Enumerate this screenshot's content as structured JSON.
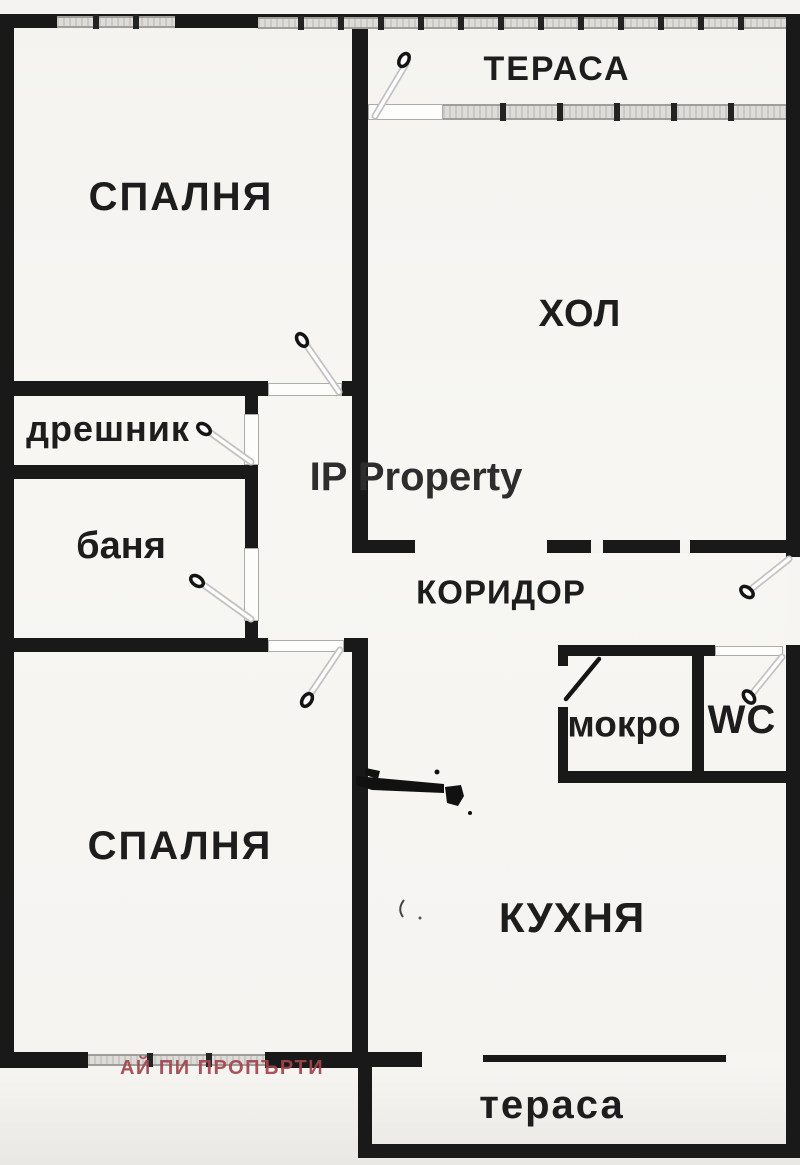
{
  "watermarks": {
    "center": "IP Property",
    "agency": "АЙ ПИ ПРОПЪРТИ"
  },
  "rooms": {
    "terrace_top": "ТЕРАСА",
    "bedroom_top": "СПАЛНЯ",
    "living_room": "ХОЛ",
    "closet": "дрешник",
    "bathroom": "баня",
    "corridor": "КОРИДОР",
    "utility": "мокро",
    "wc": "WC",
    "bedroom_bottom": "СПАЛНЯ",
    "kitchen": "КУХНЯ",
    "terrace_bottom": "тераса"
  },
  "colors": {
    "wall": "#191919",
    "window_band": "#dedcd8",
    "door_leaf_edge": "#c2c2c2",
    "watermark_center": "#2d2d2d",
    "watermark_agency": "#a3454d",
    "paper": "#f5f4f1"
  }
}
